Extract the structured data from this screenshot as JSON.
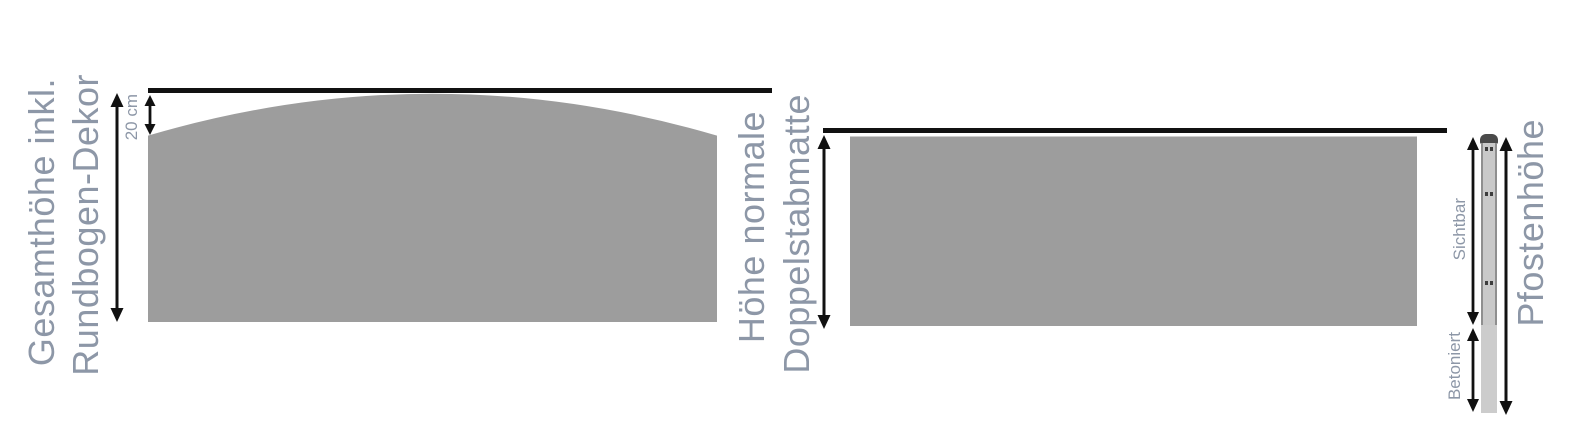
{
  "diagram": {
    "background": "#ffffff",
    "left_fence": {
      "label_line1": "Gesamthöhe inkl.",
      "label_line2": "Rundbogen-Dekor",
      "arch_rise_label": "20 cm"
    },
    "right_fence": {
      "label_line1": "Höhe normale",
      "label_line2": "Doppelstabmatte"
    },
    "post": {
      "label": "Pfostenhöhe",
      "above_ground_label": "Sichtbar",
      "below_ground_label": "Betoniert"
    },
    "colors": {
      "background": "#ffffff",
      "label_text": "#8d97a7",
      "wire": "#9d9d9d",
      "dimension_line": "#111111",
      "post_cap": "#4a4a4a",
      "post_body": "#c9c9c9",
      "post_edge": "#8f8f8f",
      "post_buried": "#cccccc"
    }
  }
}
